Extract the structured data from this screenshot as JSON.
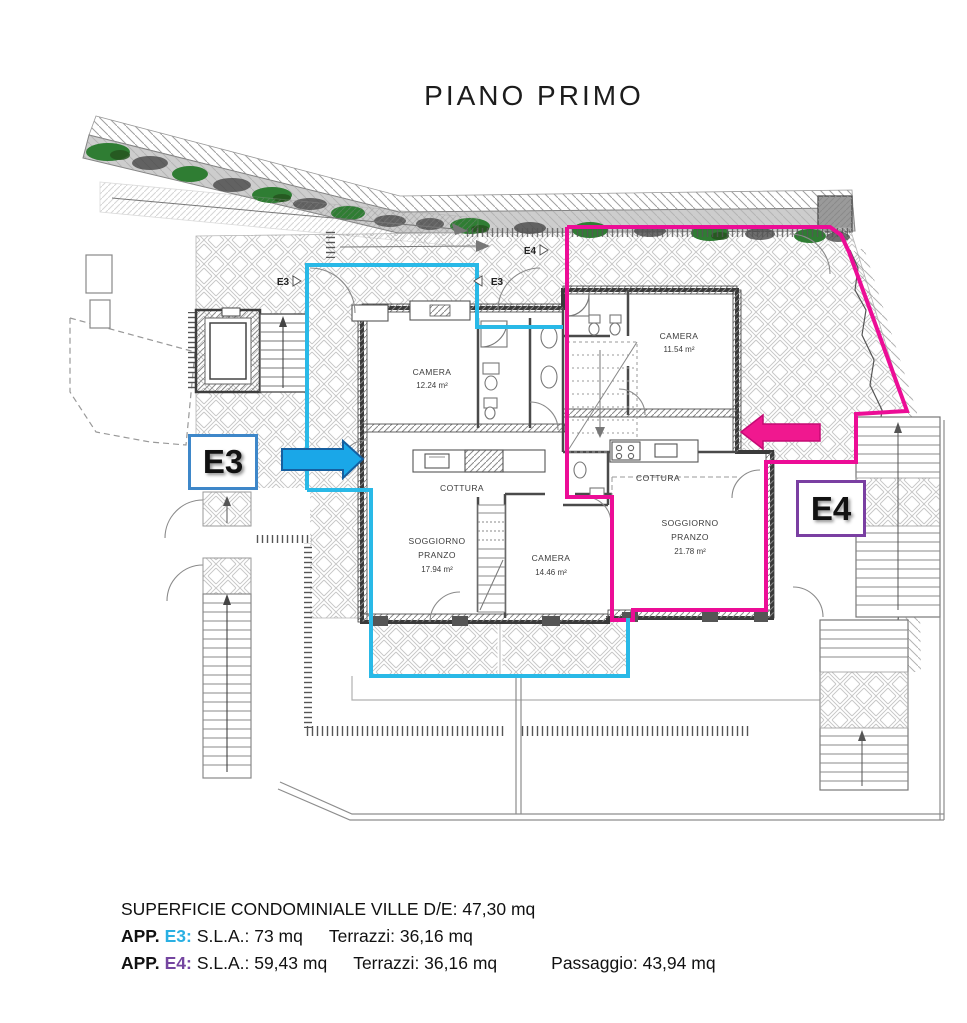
{
  "title": "PIANO PRIMO",
  "colors": {
    "e3_outline": "#29b9e7",
    "e3_box_border": "#3e87c9",
    "e4_outline": "#ec0d96",
    "e4_box_border": "#7a3fa2",
    "arrow_blue": "#1aa7e8",
    "vegetation_green": "#2f7d33"
  },
  "plan": {
    "unit_boxes": {
      "e3": "E3",
      "e4": "E4"
    },
    "markers": {
      "e3_left": "E3",
      "e3_right": "E3",
      "e4_top": "E4"
    },
    "rooms": {
      "e3_camera1": {
        "name": "CAMERA",
        "area": "12.24 m²"
      },
      "e3_cottura": {
        "name": "COTTURA"
      },
      "e3_soggiorno": {
        "name1": "SOGGIORNO",
        "name2": "PRANZO",
        "area": "17.94 m²"
      },
      "e3_camera2": {
        "name": "CAMERA",
        "area": "14.46 m²"
      },
      "e4_camera": {
        "name": "CAMERA",
        "area": "11.54 m²"
      },
      "e4_cottura": {
        "name": "COTTURA"
      },
      "e4_soggiorno": {
        "name1": "SOGGIORNO",
        "name2": "PRANZO",
        "area": "21.78 m²"
      }
    }
  },
  "legend": {
    "line1": "SUPERFICIE CONDOMINIALE VILLE D/E: 47,30 mq",
    "line2": {
      "app": "APP.",
      "unit": "E3:",
      "sla": "S.L.A.: 73 mq",
      "terrazzi": "Terrazzi: 36,16 mq"
    },
    "line3": {
      "app": "APP.",
      "unit": "E4:",
      "sla": "S.L.A.: 59,43 mq",
      "terrazzi": "Terrazzi: 36,16 mq",
      "passaggio": "Passaggio: 43,94 mq"
    }
  }
}
